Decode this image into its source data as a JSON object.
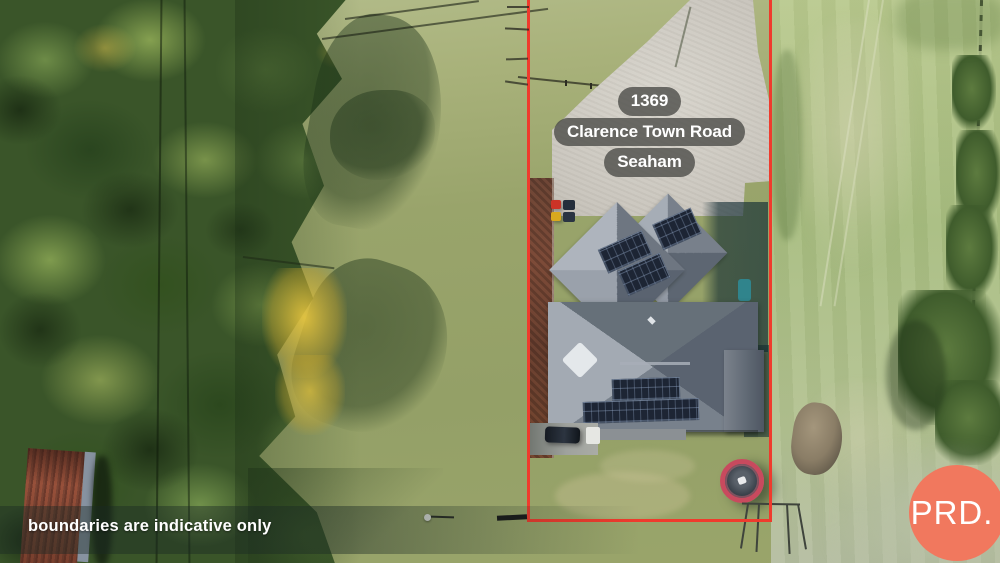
{
  "property_label": {
    "number": "1369",
    "street": "Clarence Town Road",
    "suburb": "Seaham"
  },
  "disclaimer_text": "boundaries are indicative only",
  "brand_logo_text": "PRD.",
  "colors": {
    "boundary_line": "#ef3b2d",
    "brand_circle": "#f1785e",
    "label_background": "rgba(76,76,72,0.8)"
  }
}
